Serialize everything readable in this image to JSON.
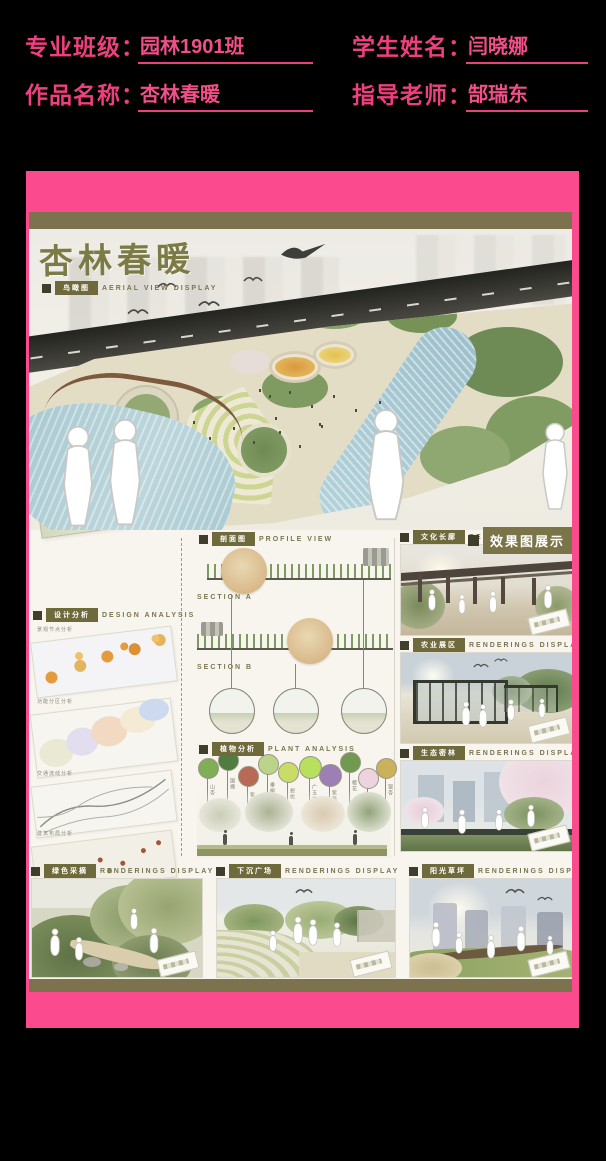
{
  "header": {
    "fields": [
      {
        "label": "专业班级：",
        "value": "园林1901班"
      },
      {
        "label": "学生姓名：",
        "value": "闫晓娜"
      },
      {
        "label": "作品名称：",
        "value": "杏林春暖"
      },
      {
        "label": "指导老师：",
        "value": "郜瑞东"
      }
    ]
  },
  "poster": {
    "title": "杏林春暖",
    "aerial": {
      "tag": "鸟瞰图",
      "tag_en": "AERIAL VIEW DISPLAY"
    },
    "badge": "效果图展示",
    "profile": {
      "tag": "剖面图",
      "tag_en": "PROFILE VIEW",
      "section_a": "SECTION A",
      "section_b": "SECTION B"
    },
    "design": {
      "tag": "设计分析",
      "tag_en": "DESIGN ANALYSIS",
      "diagrams": [
        "景观节点分析",
        "功能分区分析",
        "交通流线分析",
        "建筑布局分析"
      ]
    },
    "plant": {
      "tag": "植物分析",
      "tag_en": "PLANT ANALYSIS",
      "names": [
        "山杏",
        "国槐",
        "紫叶李",
        "垂柳",
        "碧桃",
        "广玉兰",
        "紫薇",
        "樱花",
        "白蜡",
        "银杏"
      ]
    },
    "renderings_right": [
      {
        "tag": "文化长廊",
        "tag_en": "RENDERINGS DISPLAY"
      },
      {
        "tag": "农业展区",
        "tag_en": "RENDERINGS DISPLAY"
      },
      {
        "tag": "生态密林",
        "tag_en": "RENDERINGS DISPLAY"
      }
    ],
    "renderings_bottom": [
      {
        "tag": "绿色采摘",
        "tag_en": "RENDERINGS DISPLAY"
      },
      {
        "tag": "下沉广场",
        "tag_en": "RENDERINGS DISPLAY"
      },
      {
        "tag": "阳光草坪",
        "tag_en": "RENDERINGS DISPLAY"
      }
    ],
    "colors": {
      "frame_pink": "#fb4b8e",
      "header_text_pink": "#ee3f7e",
      "band_olive": "#7d724e",
      "chip_olive": "#6f6a3c",
      "text_olive": "#7a7550",
      "background_black": "#000000"
    }
  }
}
